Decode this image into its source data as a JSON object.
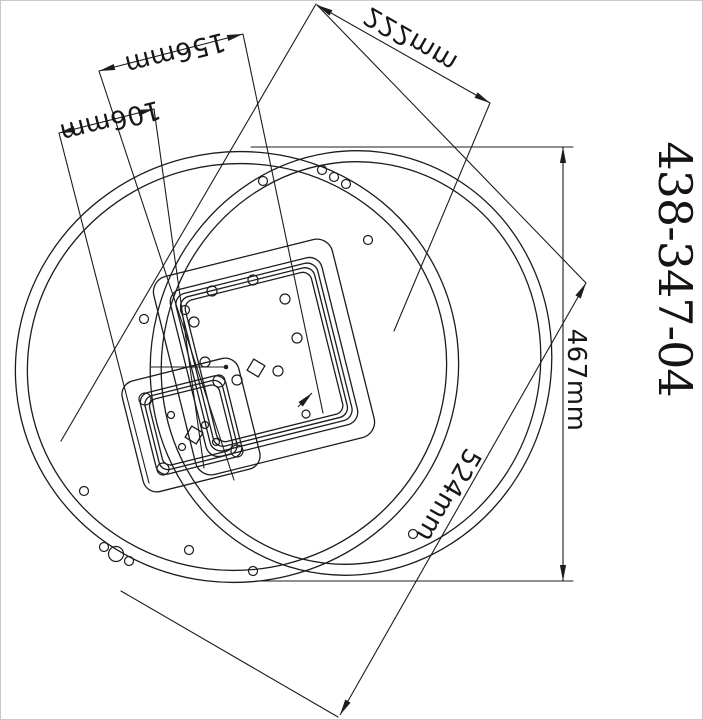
{
  "drawing": {
    "part_number": "438-347-04",
    "dims": {
      "d222": "222mm",
      "d156": "156mm",
      "d106": "106mm",
      "d467": "467mm",
      "d524": "524mm"
    },
    "colors": {
      "line": "#1c1c1c",
      "text": "#161616",
      "background": "#ffffff",
      "border": "#c9c9c9"
    }
  }
}
